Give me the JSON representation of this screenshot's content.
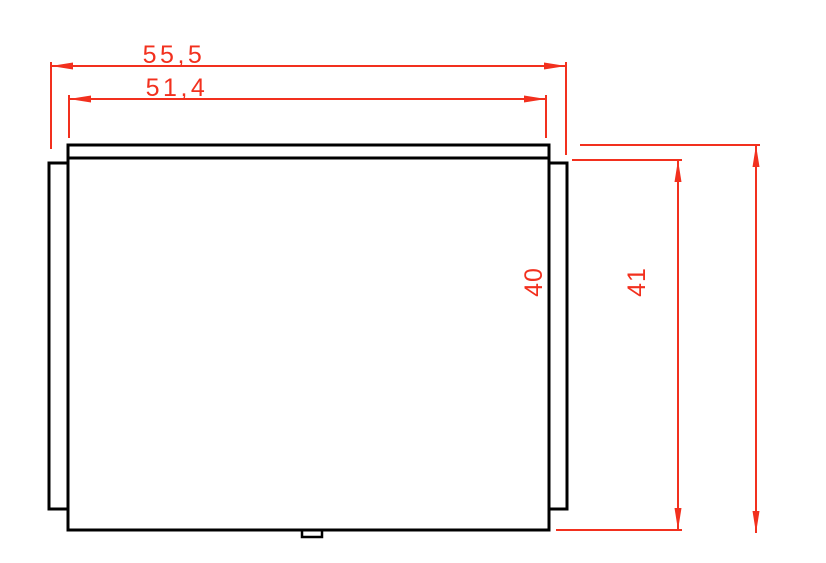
{
  "drawing": {
    "type": "2D CAD technical drawing",
    "view": "rectangular panel with left and right side flanges, top lip line and small bottom notch",
    "colors": {
      "outline": "#000000",
      "dimension": "#F2301E",
      "background": "#FFFFFF"
    },
    "dimensions": {
      "outer_width": {
        "label": "55,5",
        "value": 55.5,
        "orientation": "horizontal"
      },
      "inner_width": {
        "label": "51,4",
        "value": 51.4,
        "orientation": "horizontal"
      },
      "inner_height": {
        "label": "40",
        "value": 40,
        "orientation": "vertical"
      },
      "outer_height": {
        "label": "41",
        "value": 41,
        "orientation": "vertical"
      }
    }
  }
}
